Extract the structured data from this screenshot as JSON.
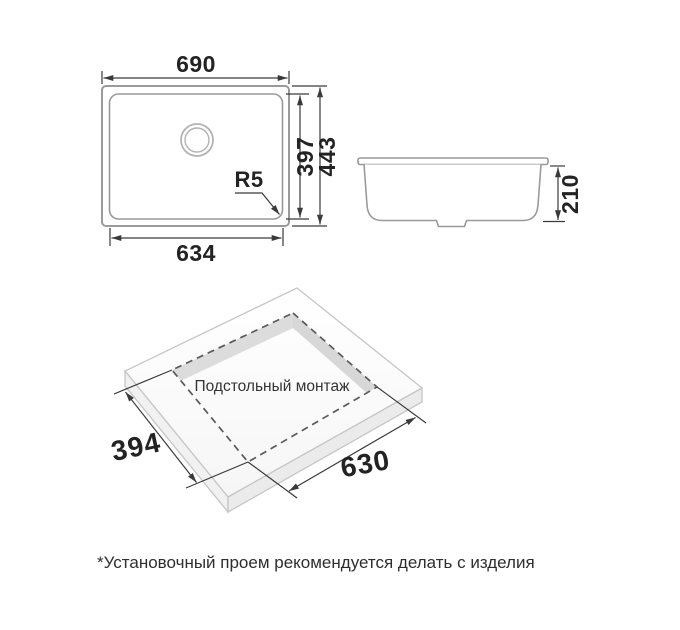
{
  "drawing": {
    "title": "sink-installation-dimensions",
    "top_view": {
      "width_overall": "690",
      "width_inner": "634",
      "height_inner": "397",
      "height_overall": "443",
      "corner_radius": "R5"
    },
    "side_view": {
      "depth": "210"
    },
    "isometric_view": {
      "label": "Подстольный монтаж",
      "cutout_width": "394",
      "cutout_length": "630"
    },
    "footnote": "*Установочный проем рекомендуется делать с изделия",
    "colors": {
      "background": "#ffffff",
      "drawing_outline": "#9a9a9a",
      "dimension_line": "#3a3a3a",
      "text": "#232323",
      "dashed_cutout": "#5a5a5a",
      "cutout_band": "#dcdcdc",
      "slab_side_face": "#f0f0f0"
    }
  }
}
